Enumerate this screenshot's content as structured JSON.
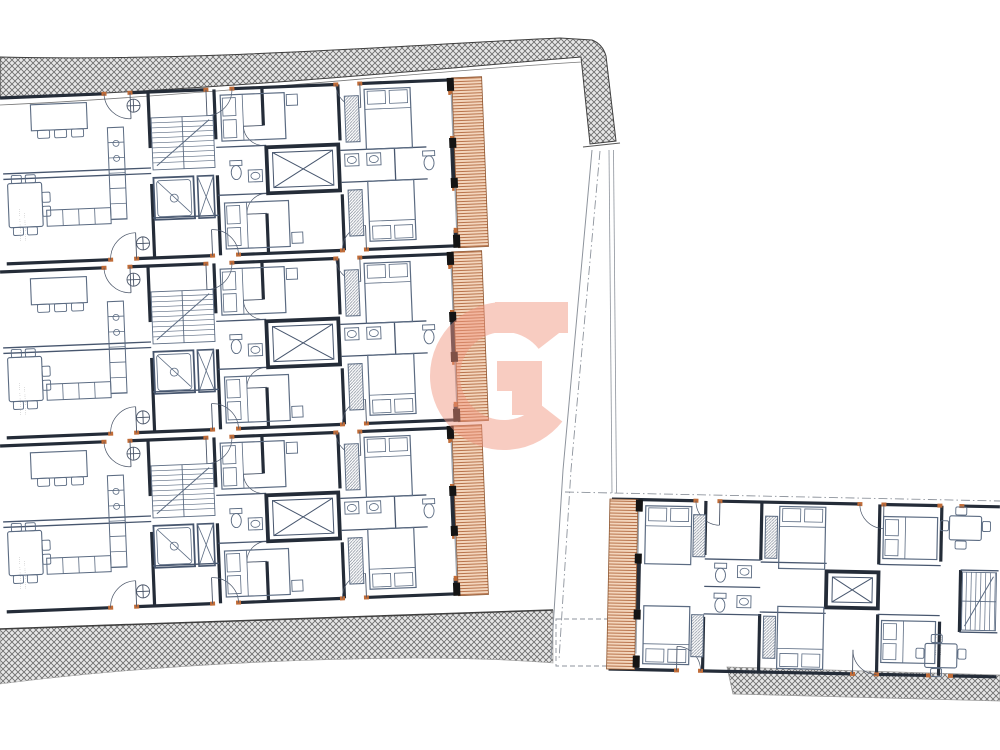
{
  "document": {
    "kind": "architectural floor plan drawing",
    "title_visible": false,
    "annotations_legible": false
  },
  "palette": {
    "paper": "#ffffff",
    "wall": "#242c38",
    "wall_light": "#47566e",
    "furniture": "#5b6b82",
    "door": "#4a5568",
    "jamb_orange": "#c06c38",
    "band_bg": "#e7e7e7",
    "band_line": "#6f6f6f",
    "band_edge": "#3f3f3f",
    "terrace_bg": "#f3d5bc",
    "terrace_line": "#b2683e",
    "terrace_edge": "#8d5631",
    "pier_black": "#141414",
    "glazing": "#9aa3ad",
    "boundary": "#8d939c",
    "watermark": "#f2957f",
    "annotation": "#555555",
    "wardrobe_line": "#7d8694"
  },
  "layout": {
    "canvas": {
      "w": 1000,
      "h": 750
    },
    "left_building": {
      "x": 0,
      "y": 96,
      "rotation_deg": -2.3,
      "unit_pitch": 174,
      "unit_count": 3,
      "unit_w": 482,
      "unit_h": 170
    },
    "right_building": {
      "x": 610,
      "y": 497,
      "rotation_deg": 1.15,
      "w": 390,
      "h": 175
    },
    "top_band": {
      "path": "M0,57 C200,62 420,44 560,38 L592,40 C600,43 604,49 606,56 L616,141 L590,144 L581,57 C470,66 250,88 0,98 Z",
      "road_line": "M0,105 C200,96 440,70 582,62",
      "tick": "M583,147 L620,143"
    },
    "bottom_left_band": {
      "path": "M0,629 L553,610 L553,663 C420,652 180,661 0,684 Z",
      "edge": "M0,629 L553,610"
    },
    "bottom_right_band": {
      "path": "M727,667 L1000,675 L1000,701 L733,694 Z"
    },
    "dashed_rect": {
      "x": 556,
      "y": 619,
      "w": 54,
      "h": 47
    },
    "boundary": {
      "solid": "M592,150 L563,470 L551,660",
      "dashdot": "M600,151 L571,470 L559,660",
      "vert1": "M609,150 L612,493",
      "vert2": "M613.5,150 L616.5,493",
      "horiz_dashdot": "M565,492 L1000,501"
    },
    "watermark": {
      "glyph": "G",
      "cx": 504,
      "cy": 376,
      "r": 59,
      "stroke_w": 30,
      "opening_half_deg": 38,
      "top_bar": [
        495,
        302,
        73,
        31
      ],
      "cross_bar": [
        497,
        361,
        45,
        30
      ],
      "stub": [
        512,
        391,
        30,
        24
      ],
      "opacity": 0.48
    }
  },
  "annotations": {
    "font_px": 3.2,
    "unit_label_lines": [
      "··· ····· ·· ····",
      "···· ·· ··· ···"
    ],
    "right_label_lines": [
      "··· ···· ···",
      "···· ·· ····"
    ]
  }
}
